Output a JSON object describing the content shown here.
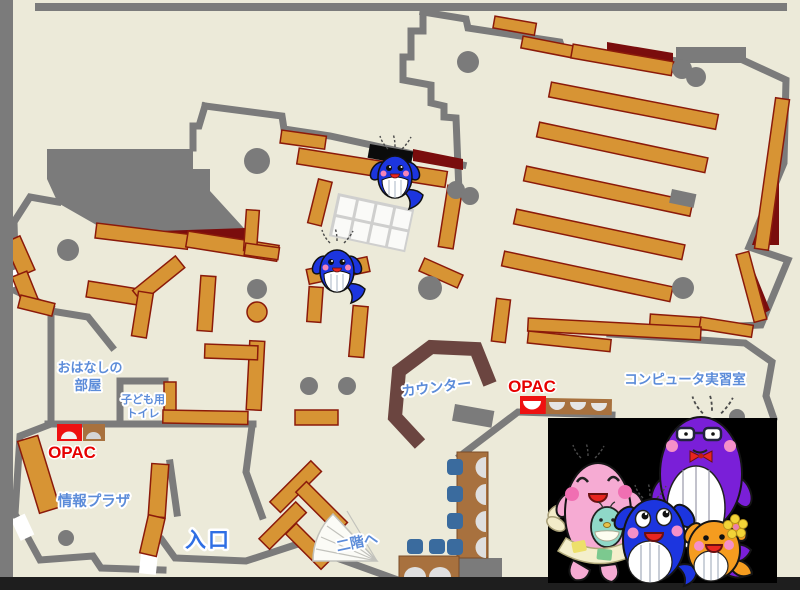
{
  "map": {
    "labels": {
      "storytelling_room": {
        "line1": "おはなしの",
        "line2": "部屋"
      },
      "kids_toilet": {
        "line1": "子ども用",
        "line2": "トイレ"
      },
      "opac_left": "OPAC",
      "opac_right": "OPAC",
      "info_plaza": "情報プラザ",
      "entrance": "入口",
      "counter": "カウンター",
      "computer_room": "コンピュータ実習室",
      "to_second_floor": "二階へ"
    },
    "colors": {
      "floor": "#ECEAD9",
      "wall": "#7B7B7B",
      "frame_bottom": "#1E1E1E",
      "shelf": "#D79434",
      "shelf_border": "#8B1A0A",
      "dark_red": "#7A0D0D",
      "counter": "#6B4540",
      "desk": "#A8713E",
      "chair": "#3A6B9E",
      "opac_red": "#EE1111",
      "label_blue": "#5C8CD9",
      "label_red": "#E60000",
      "entrance_blue": "#2F6FE4",
      "mascot_blue": "#1C35DF",
      "mascot_pink": "#F6ABD3",
      "mascot_purple": "#7A1FD8",
      "mascot_orange": "#F59C1F",
      "mascot_teal": "#8FD8C8",
      "panel_black": "#000000"
    },
    "mascots": {
      "map_sprites": "blue-whale",
      "family": [
        "pink-whale-parent",
        "teal-whale-baby",
        "purple-whale-parent",
        "blue-whale-child",
        "orange-whale-child"
      ]
    }
  }
}
